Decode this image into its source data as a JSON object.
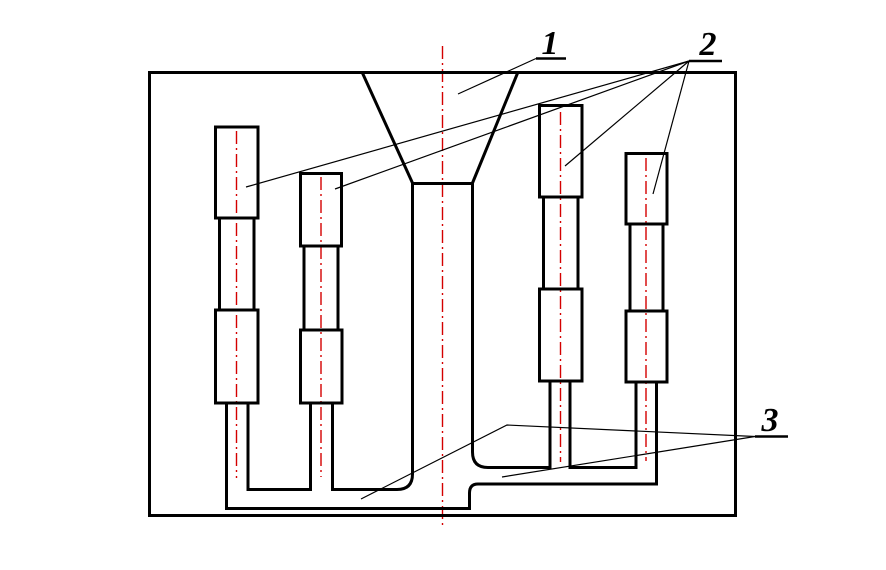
{
  "drawing": {
    "type": "engineering-diagram-gating-system",
    "labels": {
      "label_1": "1",
      "label_2": "2",
      "label_3": "3"
    },
    "colors": {
      "outline": "#000000",
      "centerline": "#d40000",
      "background": "#ffffff"
    }
  }
}
